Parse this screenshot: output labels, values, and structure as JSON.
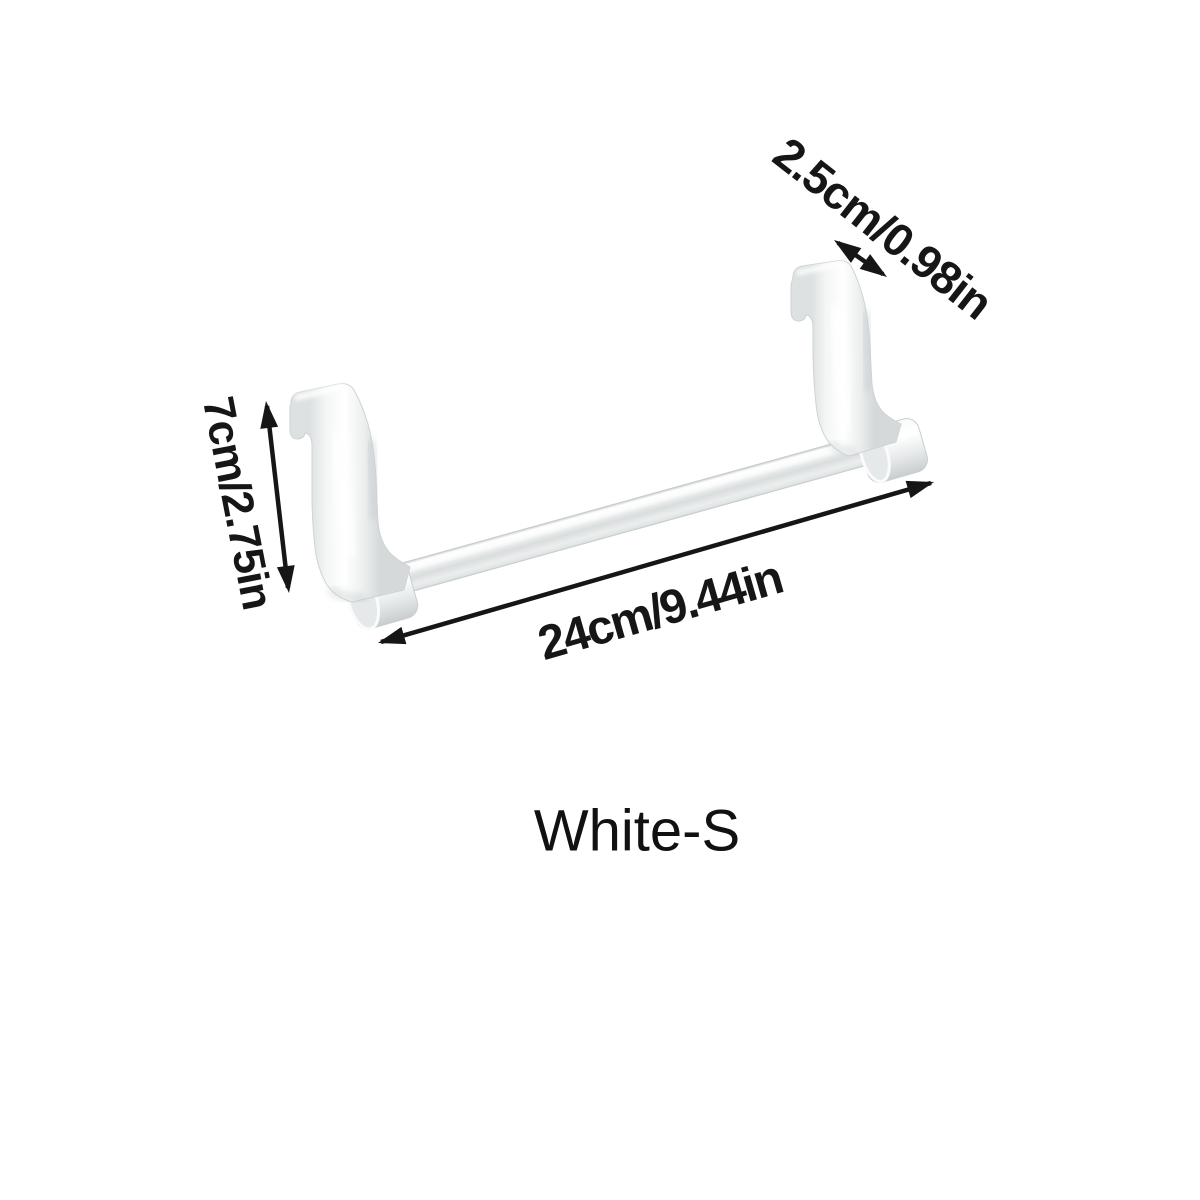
{
  "page": {
    "background_color": "#ffffff",
    "annotation_color": "#161616"
  },
  "product": {
    "variant_label": "White-S",
    "body_color": "#f3f4f5",
    "shade_color": "#d6dadb"
  },
  "dimensions": {
    "hook_depth": {
      "label": "2.5cm/0.98in",
      "icon": "double-headed-arrow"
    },
    "hook_height": {
      "label": "7cm/2.75in",
      "icon": "double-headed-arrow"
    },
    "bar_length": {
      "label": "24cm/9.44in",
      "icon": "double-headed-arrow"
    }
  }
}
